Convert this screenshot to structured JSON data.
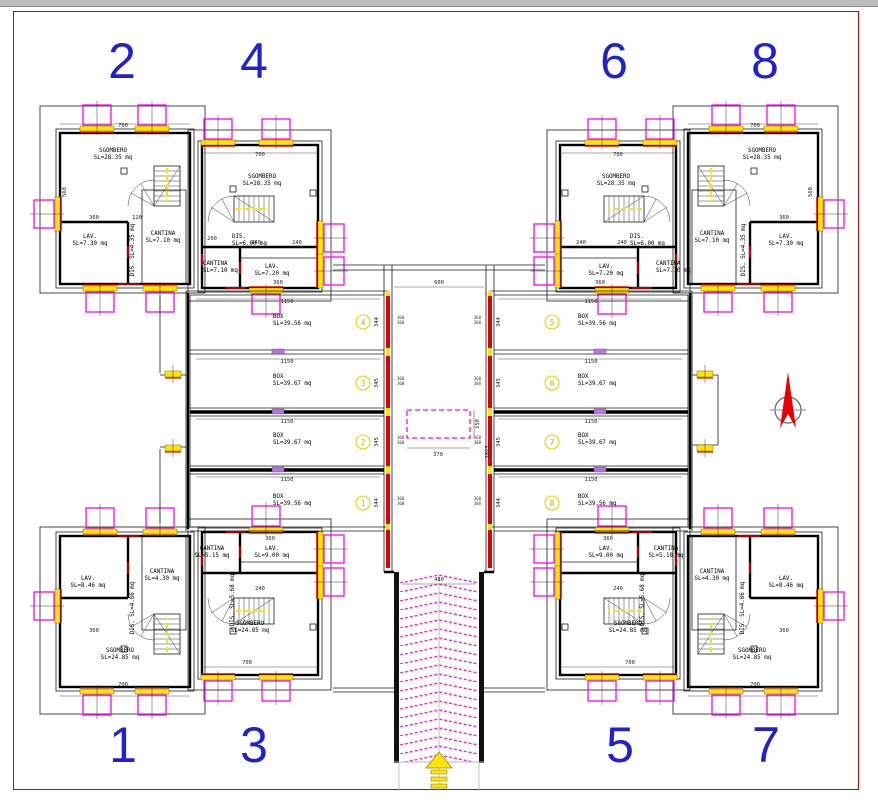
{
  "title": "basement-floor-plan",
  "unit_numbers": {
    "u1": "1",
    "u2": "2",
    "u3": "3",
    "u4": "4",
    "u5": "5",
    "u6": "6",
    "u7": "7",
    "u8": "8"
  },
  "rooms": {
    "u1": {
      "lav": "LAV.",
      "lava": "SL=8.46 mq",
      "cant": "CANTINA",
      "canta": "SL=4.30 mq",
      "disv": "DIS. SL=4.86 mq",
      "sg": "SGOMBERO",
      "sga": "SL=24.85 mq"
    },
    "u2": {
      "sg": "SGOMBERO",
      "sga": "SL=28.35 mq",
      "lav": "LAV.",
      "lava": "SL=7.30 mq",
      "cant": "CANTINA",
      "canta": "SL=7.10 mq",
      "disv": "DIS. SL=4.35 mq"
    },
    "u3": {
      "cant": "CANTINA",
      "canta": "SL=5.15 mq",
      "lav": "LAV.",
      "lava": "SL=9.00 mq",
      "disv": "DIS. SL=5.68 mq",
      "sg": "SGOMBERO",
      "sga": "SL=24.85 mq"
    },
    "u4": {
      "sg": "SGOMBERO",
      "sga": "SL=28.35 mq",
      "dis": "DIS.",
      "disa": "SL=6.00 mq",
      "cant": "CANTINA",
      "canta": "SL=7.10 mq",
      "lav": "LAV.",
      "lava": "SL=7.20 mq"
    },
    "u5": {
      "lav": "LAV.",
      "lava": "SL=9.00 mq",
      "cant": "CANTINA",
      "canta": "SL=5.18 mq",
      "disv": "DIS. SL=5.68 mq",
      "sg": "SGOMBERO",
      "sga": "SL=24.85 mq"
    },
    "u6": {
      "sg": "SGOMBERO",
      "sga": "SL=28.35 mq",
      "dis": "DIS.",
      "disa": "SL=6.00 mq",
      "cant": "CANTINA",
      "canta": "SL=7.10 mq",
      "lav": "LAV.",
      "lava": "SL=7.20 mq"
    },
    "u7": {
      "cant": "CANTINA",
      "canta": "SL=4.30 mq",
      "lav": "LAV.",
      "lava": "SL=8.46 mq",
      "disv": "DIS. SL=4.86 mq",
      "sg": "SGOMBERO",
      "sga": "SL=24.85 mq"
    },
    "u8": {
      "sg": "SGOMBERO",
      "sga": "SL=28.35 mq",
      "cant": "CANTINA",
      "canta": "SL=7.10 mq",
      "lav": "LAV.",
      "lava": "SL=7.30 mq",
      "disv": "DIS. SL=4.35 mq"
    }
  },
  "boxes": {
    "b1": {
      "num": "1",
      "label": "BOX",
      "area": "SL=39.56 mq"
    },
    "b2": {
      "num": "2",
      "label": "BOX",
      "area": "SL=39.67 mq"
    },
    "b3": {
      "num": "3",
      "label": "BOX",
      "area": "SL=39.67 mq"
    },
    "b4": {
      "num": "4",
      "label": "BOX",
      "area": "SL=39.56 mq"
    },
    "b5": {
      "num": "5",
      "label": "BOX",
      "area": "SL=39.56 mq"
    },
    "b6": {
      "num": "6",
      "label": "BOX",
      "area": "SL=39.67 mq"
    },
    "b7": {
      "num": "7",
      "label": "BOX",
      "area": "SL=39.67 mq"
    },
    "b8": {
      "num": "8",
      "label": "BOX",
      "area": "SL=39.56 mq"
    }
  },
  "dims": {
    "d600": "600",
    "d1150": "1150",
    "d700": "700",
    "d480": "480",
    "d370": "370",
    "d150": "150",
    "d1823": "1823",
    "d344": "344",
    "d345": "345",
    "d360": "360",
    "d240": "240",
    "d120": "120",
    "d200": "200",
    "d560": "560",
    "op_top": "360",
    "op_bot": "300"
  },
  "north": {
    "label": "N"
  },
  "colors": {
    "frame": "#cf0000",
    "walls": "#000000",
    "accent_red": "#e10000",
    "magenta": "#ff00ff",
    "yellow": "#ffe600",
    "violet": "#b973e6",
    "unit_blue": "#2222cc",
    "badge_yellow": "#e8d200"
  }
}
